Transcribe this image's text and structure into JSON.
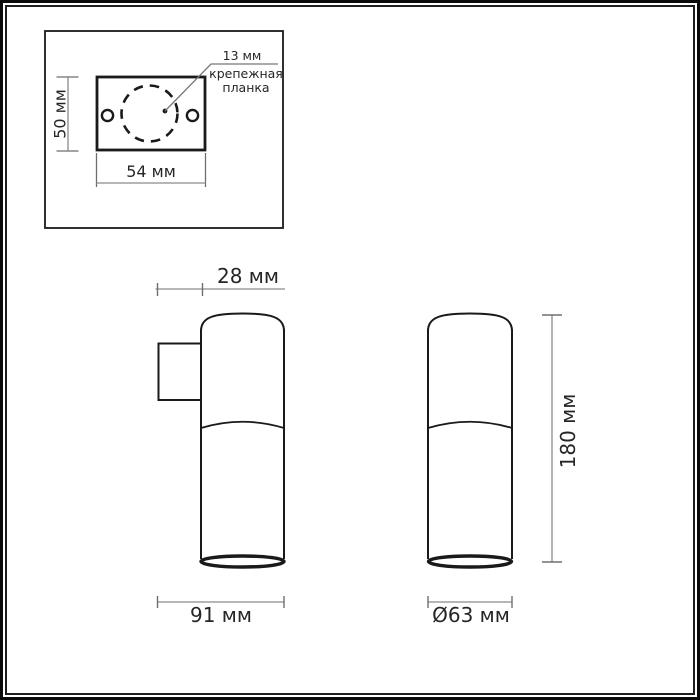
{
  "drawing_title": "luminaire-dimension-drawing",
  "colors": {
    "background": "#ffffff",
    "outline": "#1a1a1a",
    "dimension_line": "#8a8a8a",
    "text": "#262626",
    "frame": "#0a0a0a"
  },
  "mounting_plate_inset": {
    "leader_dim": "13 мм",
    "leader_label_line1": "крепежная",
    "leader_label_line2": "планка",
    "plate_height_dim": "50 мм",
    "plate_width_dim": "54 мм"
  },
  "wall_mount_view": {
    "bracket_depth_dim": "28 мм",
    "total_depth_dim": "91 мм"
  },
  "body_view": {
    "height_dim": "180 мм",
    "diameter_dim": "Ø63 мм"
  }
}
